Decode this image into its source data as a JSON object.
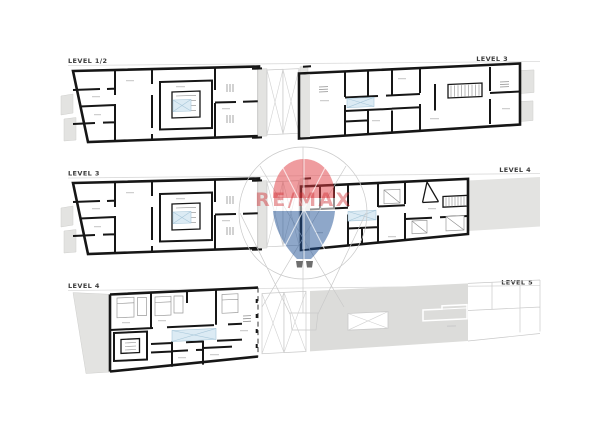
{
  "page": {
    "background": "#ffffff",
    "kind": "architectural floor plans"
  },
  "rows": [
    {
      "left_label": "LEVEL 1/2",
      "right_label": "LEVEL 3"
    },
    {
      "left_label": "LEVEL 3",
      "right_label": "LEVEL 4"
    },
    {
      "left_label": "LEVEL 4",
      "right_label": "LEVEL 5"
    }
  ],
  "watermark": {
    "brand": "RE/MAX",
    "balloon_top_color": "#e03a3f",
    "balloon_bottom_color": "#1d4f93",
    "text_color": "#d23237"
  },
  "colors": {
    "wall": "#161616",
    "terrace_gray": "#e3e3e1",
    "roof_gray": "#dcdcda",
    "void_blue": "#dcebf4",
    "faint_line": "#c9c9c9",
    "label_text": "#3b3b3b"
  }
}
